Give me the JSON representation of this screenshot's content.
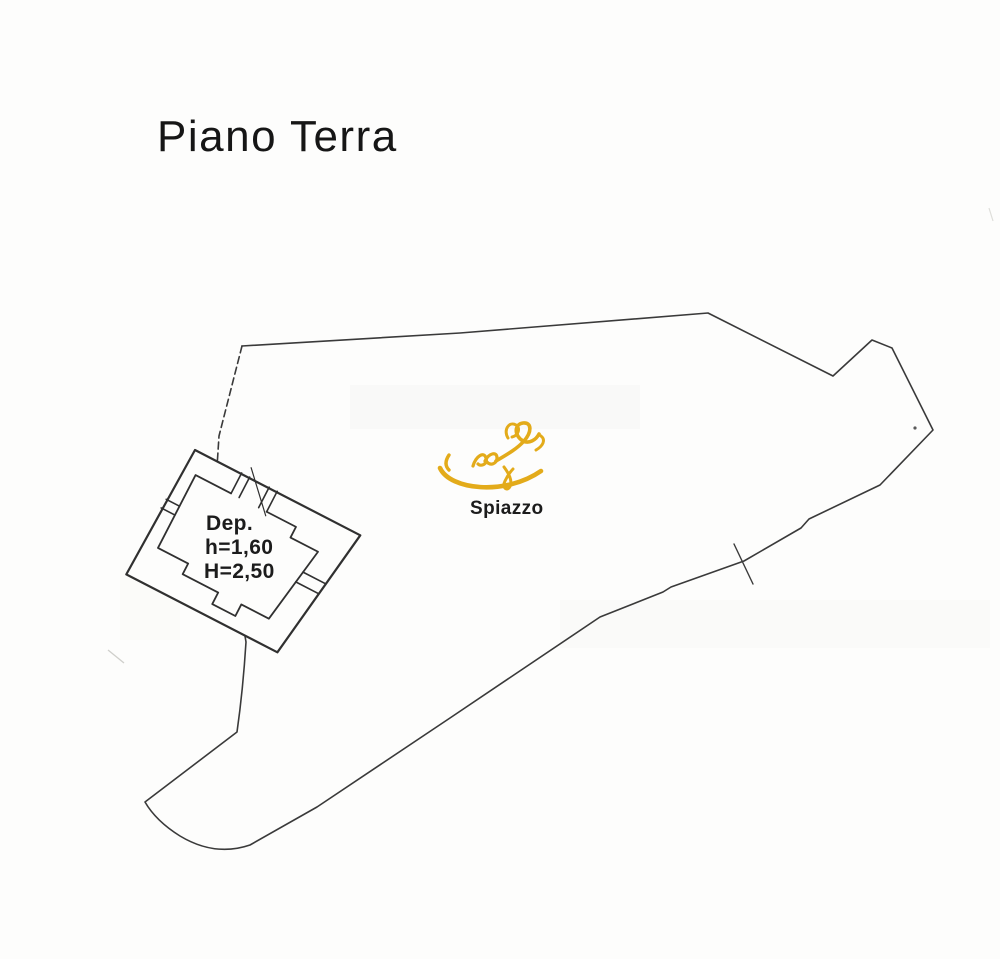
{
  "document": {
    "title": "Piano Terra"
  },
  "plan": {
    "building": {
      "label": "Dep.",
      "height_minor": "h=1,60",
      "height_major": "H=2,50"
    },
    "area": {
      "label": "Spiazzo"
    },
    "icons": {
      "signature": "signature-scribble-gold"
    },
    "colors": {
      "ink": "#3a3a3a",
      "building_ink": "#303030",
      "text": "#1c1c1c",
      "signature_gold": "#e3ab1a",
      "paper": "#fdfdfc"
    }
  }
}
